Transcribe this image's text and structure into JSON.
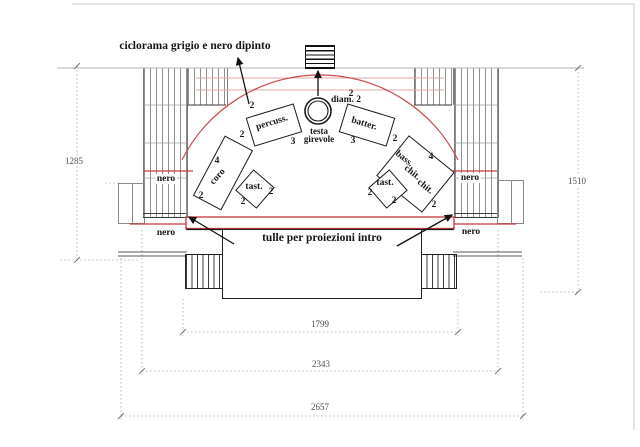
{
  "note_ciclorama": "ciclorama grigio e nero dipinto",
  "stage": {
    "tulle_label": "tulle per proiezioni intro",
    "turntable": {
      "line1": "testa",
      "line2": "girevole",
      "diameter": "diam. 2"
    },
    "instruments": {
      "percussion": "percuss.",
      "drums": "batter.",
      "choir": "coro",
      "bass": "bass.",
      "guitar_a": "chit.",
      "guitar_b": "chit.",
      "keys_left": "tast.",
      "keys_right": "tast."
    },
    "numbers": {
      "percuss_side": "2",
      "percuss_front": "3",
      "percuss_top": "2",
      "batter_front": "3",
      "batter_side": "2",
      "batter_top": "2",
      "coro_count": "4",
      "coro_side": "2",
      "guitar_count": "4",
      "guitar_side": "2",
      "tast_left_a": "2",
      "tast_left_b": "2",
      "tast_right_a": "2",
      "tast_right_b": "2"
    },
    "curtains": {
      "left_mid": "nero",
      "left_low": "nero",
      "right_mid": "nero",
      "right_low": "nero"
    }
  },
  "dimensions": {
    "left_height": "1285",
    "right_height": "1510",
    "inner_width": "1799",
    "middle_width": "2343",
    "outer_width": "2657"
  },
  "colors": {
    "red": "#c84b4b",
    "pink": "#e2a7a7",
    "ink": "#1a1a1a"
  }
}
